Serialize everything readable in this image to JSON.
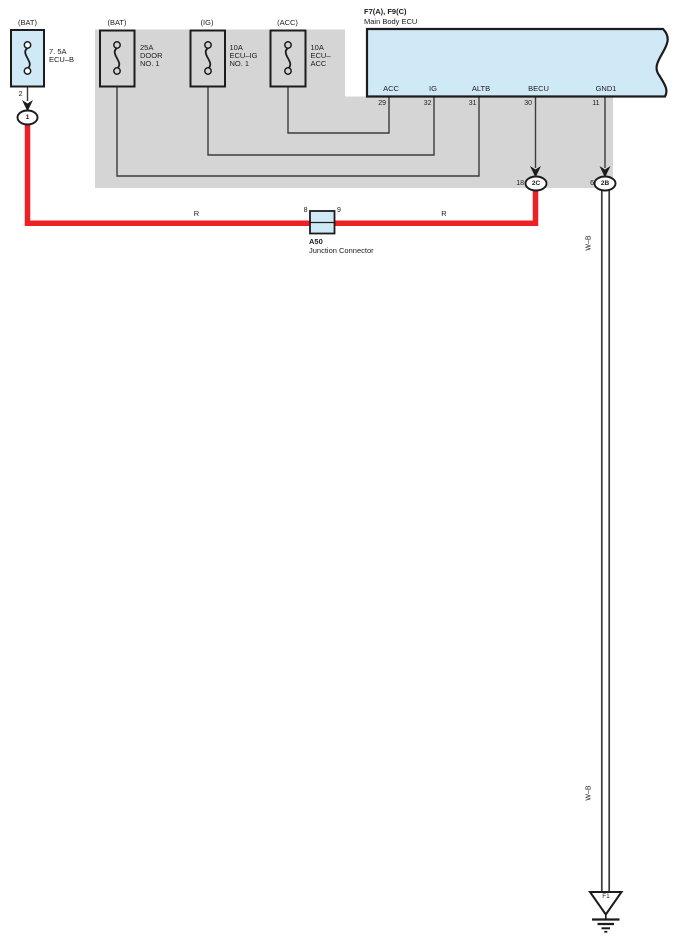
{
  "colors": {
    "component_blue": "#cfe9f7",
    "block_gray": "#d5d5d5",
    "wire_red": "#ed2024",
    "wire_line": "#3d3d3d",
    "ink": "#1c1c1c"
  },
  "fuses": [
    {
      "top_label": "(BAT)",
      "side_label": "7. 5A\nECU–B"
    },
    {
      "top_label": "(BAT)",
      "side_label": "25A\nDOOR\nNO. 1"
    },
    {
      "top_label": "(IG)",
      "side_label": "10A\nECU–IG\nNO. 1"
    },
    {
      "top_label": "(ACC)",
      "side_label": "10A\nECU–\nACC"
    }
  ],
  "ecu": {
    "title": "F7(A), F9(C)",
    "subtitle": "Main Body ECU",
    "pins": [
      {
        "name": "ACC",
        "num": "29"
      },
      {
        "name": "IG",
        "num": "32"
      },
      {
        "name": "ALTB",
        "num": "31"
      },
      {
        "name": "BECU",
        "num": "30"
      },
      {
        "name": "GND1",
        "num": "11"
      }
    ]
  },
  "connectors": {
    "fuse_out": {
      "pin": "2",
      "id": "1"
    },
    "becu": {
      "pin": "18",
      "id": "2C"
    },
    "gnd": {
      "pin": "6",
      "id": "2B"
    }
  },
  "junction": {
    "id": "A50",
    "name": "Junction Connector",
    "pin_left": "8",
    "pin_right": "9"
  },
  "wire_labels": {
    "red_left": "R",
    "red_right": "R",
    "wb_upper": "W–B",
    "wb_lower": "W–B"
  },
  "ground": {
    "id": "F1"
  }
}
